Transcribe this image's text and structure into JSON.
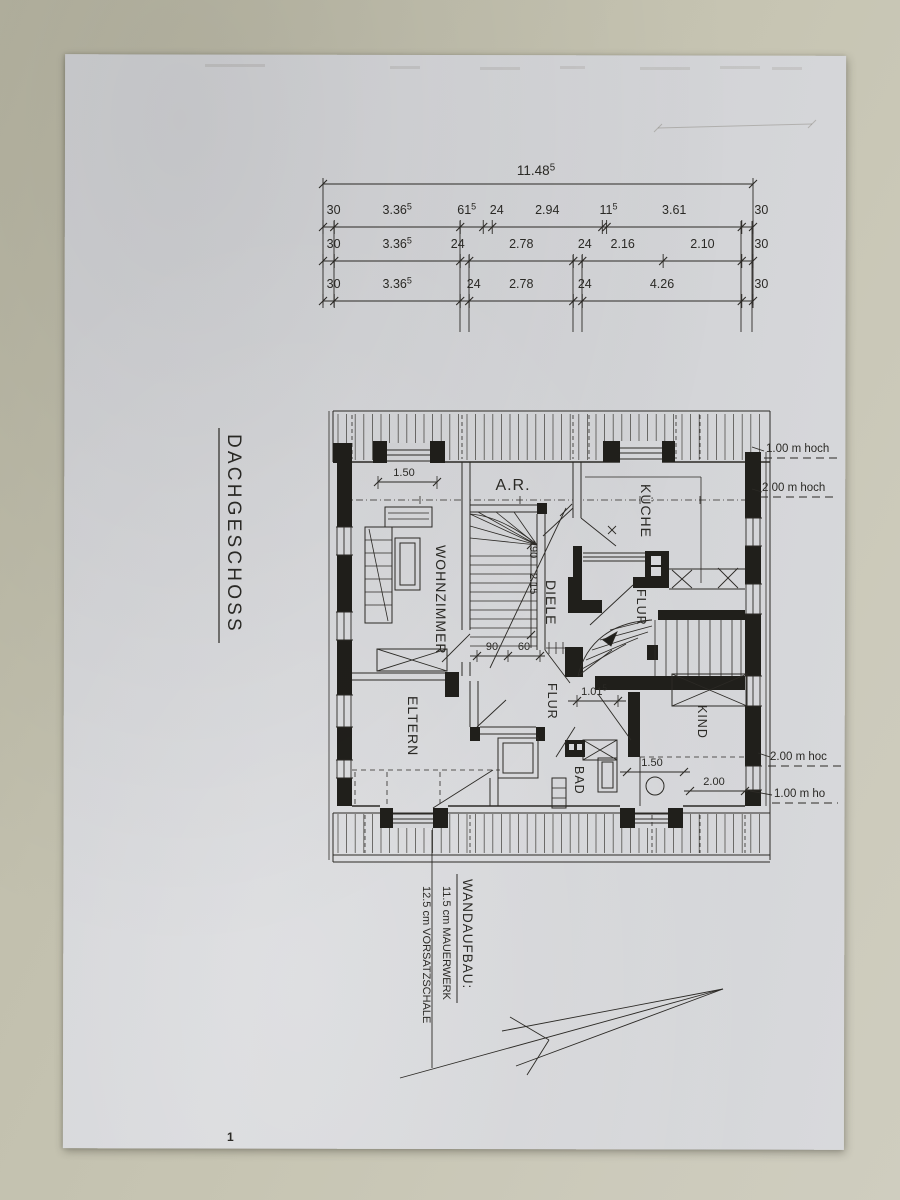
{
  "title": "DACHGESCHOSS",
  "dim_chain": {
    "total": {
      "t": "11.48",
      "sup": "5"
    },
    "rows": [
      [
        {
          "t": "30"
        },
        {
          "t": "3.36",
          "sup": "5"
        },
        {
          "t": "61",
          "sup": "5"
        },
        {
          "t": "24"
        },
        {
          "t": "2.94"
        },
        {
          "t": "11",
          "sup": "5"
        },
        {
          "t": "3.61"
        },
        {
          "t": "30"
        }
      ],
      [
        {
          "t": "30"
        },
        {
          "t": "3.36",
          "sup": "5"
        },
        {
          "t": "24"
        },
        {
          "t": "2.78"
        },
        {
          "t": "24"
        },
        {
          "t": "2.16"
        },
        {
          "t": "2.10"
        },
        {
          "t": "30"
        }
      ],
      [
        {
          "t": "30"
        },
        {
          "t": "3.36",
          "sup": "5"
        },
        {
          "t": "24"
        },
        {
          "t": "2.78"
        },
        {
          "t": "24"
        },
        {
          "t": "4.26"
        },
        {
          "t": "30"
        }
      ]
    ]
  },
  "room_labels": [
    {
      "id": "wohnzimmer",
      "text": "WOHNZIMMER"
    },
    {
      "id": "abstellraum",
      "text": "A.R."
    },
    {
      "id": "kueche",
      "text": "KÜCHE"
    },
    {
      "id": "diele",
      "text": "DIELE"
    },
    {
      "id": "flur-oben",
      "text": "FLUR"
    },
    {
      "id": "eltern",
      "text": "ELTERN"
    },
    {
      "id": "flur-unten",
      "text": "FLUR"
    },
    {
      "id": "bad",
      "text": "BAD"
    },
    {
      "id": "kind",
      "text": "KIND"
    }
  ],
  "interior_dimensions": [
    {
      "id": "fenster-wohnzimmer",
      "t": "1.50"
    },
    {
      "id": "treppe-breite",
      "t": "90"
    },
    {
      "id": "treppe-lauf",
      "t": "2.15"
    },
    {
      "id": "tuer-90",
      "t": "90"
    },
    {
      "id": "tuer-60",
      "t": "60"
    },
    {
      "id": "flur-breite",
      "t": "1.01",
      "sup": "5"
    },
    {
      "id": "kind-fenster",
      "t": "1.50"
    },
    {
      "id": "kind-nische",
      "t": "2.00"
    }
  ],
  "height_notes": [
    {
      "id": "hoehe-oben-1",
      "text": "1.00 m hoch"
    },
    {
      "id": "hoehe-oben-2",
      "text": "2.00 m hoch"
    },
    {
      "id": "hoehe-unten-2",
      "text": "2.00 m hoc"
    },
    {
      "id": "hoehe-unten-1",
      "text": "1.00 m ho"
    }
  ],
  "wall_note": {
    "heading": "WANDAUFBAU:",
    "line1": "11.5 cm  MAUERWERK",
    "line2": "12.5 cm  VORSATZSCHALE"
  },
  "page_number": "1"
}
